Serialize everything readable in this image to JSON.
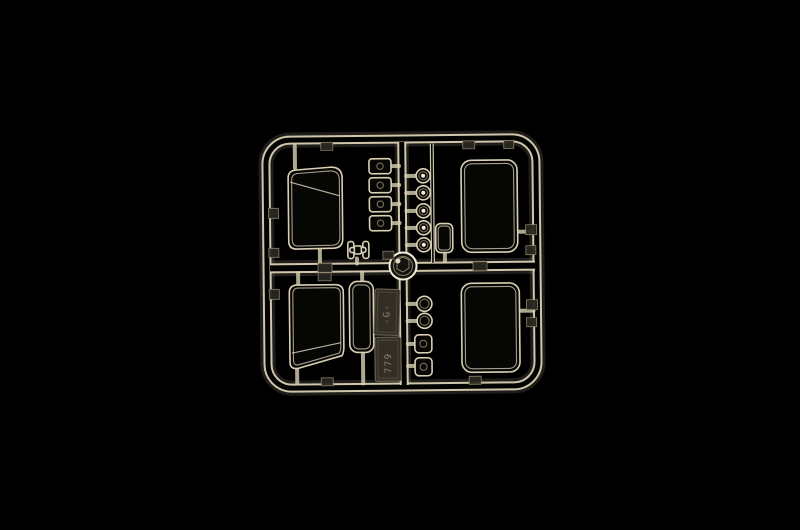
{
  "photo": {
    "subject": "clear-plastic-model-kit-sprue",
    "background": "black",
    "markings": {
      "code_top": "-G-",
      "code_bottom": "779"
    },
    "colors": {
      "bg": "#000000",
      "hi": "#d9d0b4",
      "hi_bright": "#f2ecd8",
      "dim": "#8f866d",
      "plate": "#332f27",
      "emboss": "#9a9178"
    }
  }
}
